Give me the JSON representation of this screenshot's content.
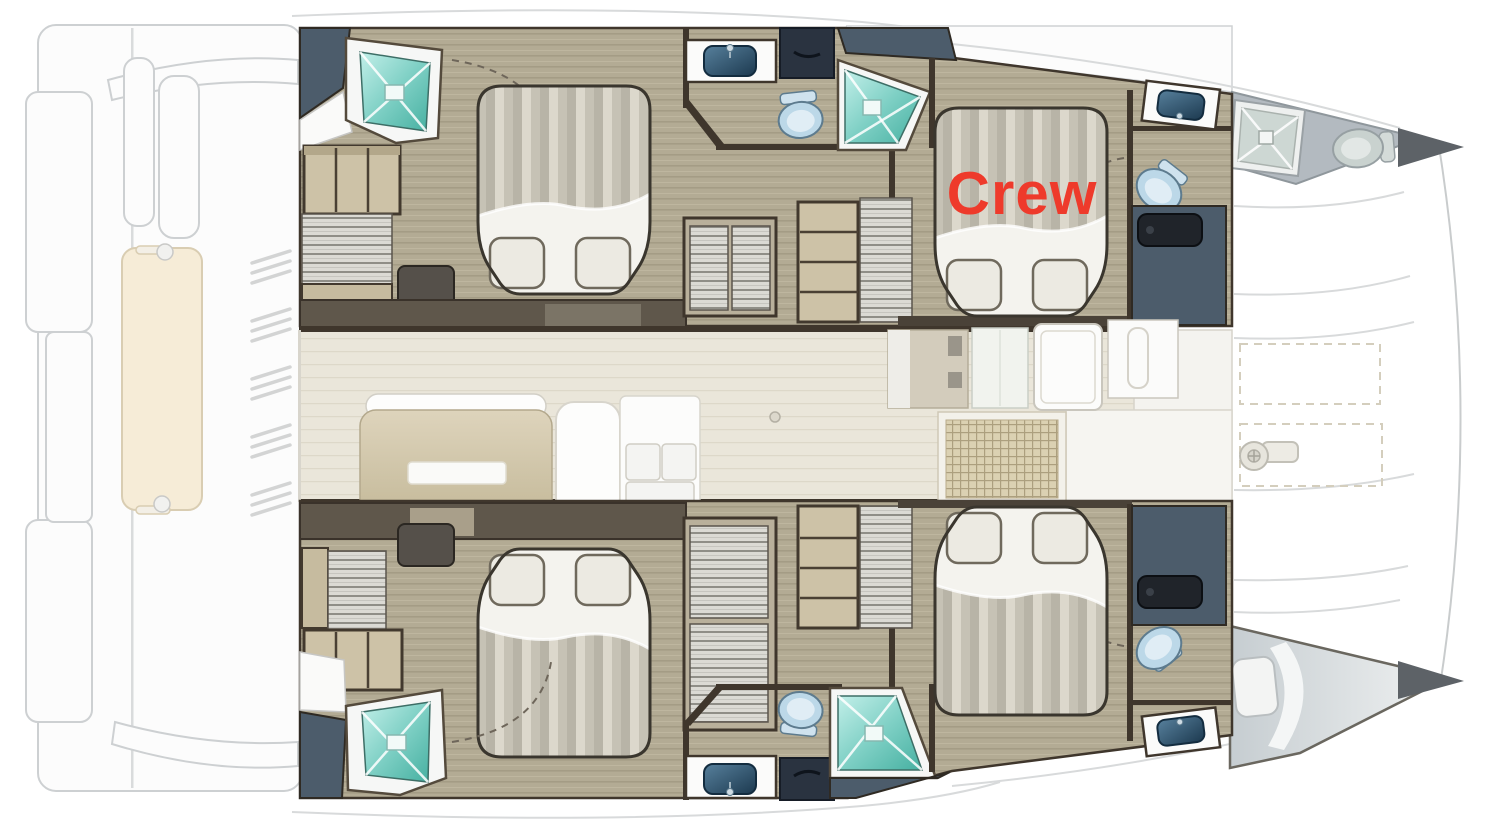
{
  "title": "Catamaran cabin layout floor plan",
  "label": {
    "text": "Crew",
    "color": "#ee3a2b"
  },
  "icons": [
    "double-bed",
    "pillow",
    "shower-icon",
    "toilet-icon",
    "sink-icon",
    "wardrobe-shelves",
    "hanging-locker",
    "drawer",
    "salon-table",
    "settee",
    "sun-lounger",
    "windlass-icon",
    "grid-hatch",
    "door-swing-arc"
  ],
  "palette": {
    "wood_floor": "#b3ab94",
    "salon_floor": "#eae6da",
    "wall_brown": "#3f362c",
    "shelf_tan": "#cdc2a7",
    "shower_teal": "#46b0a1",
    "shower_teal_light": "#c2efe9",
    "slate_blue": "#4c5c6b",
    "toilet_blue": "#bcd8e8",
    "sink_navy": "#1c394f",
    "bed_stripe_light": "#dcd8cc",
    "bed_stripe_dark": "#b8b4a7",
    "linen_white": "#f4f3ee",
    "deck_faded_stroke": "#cdd0d2",
    "foredeck_gray": "#b3bac0",
    "lounger_cream": "#f6ecd7",
    "label_red": "#ee3a2b"
  }
}
